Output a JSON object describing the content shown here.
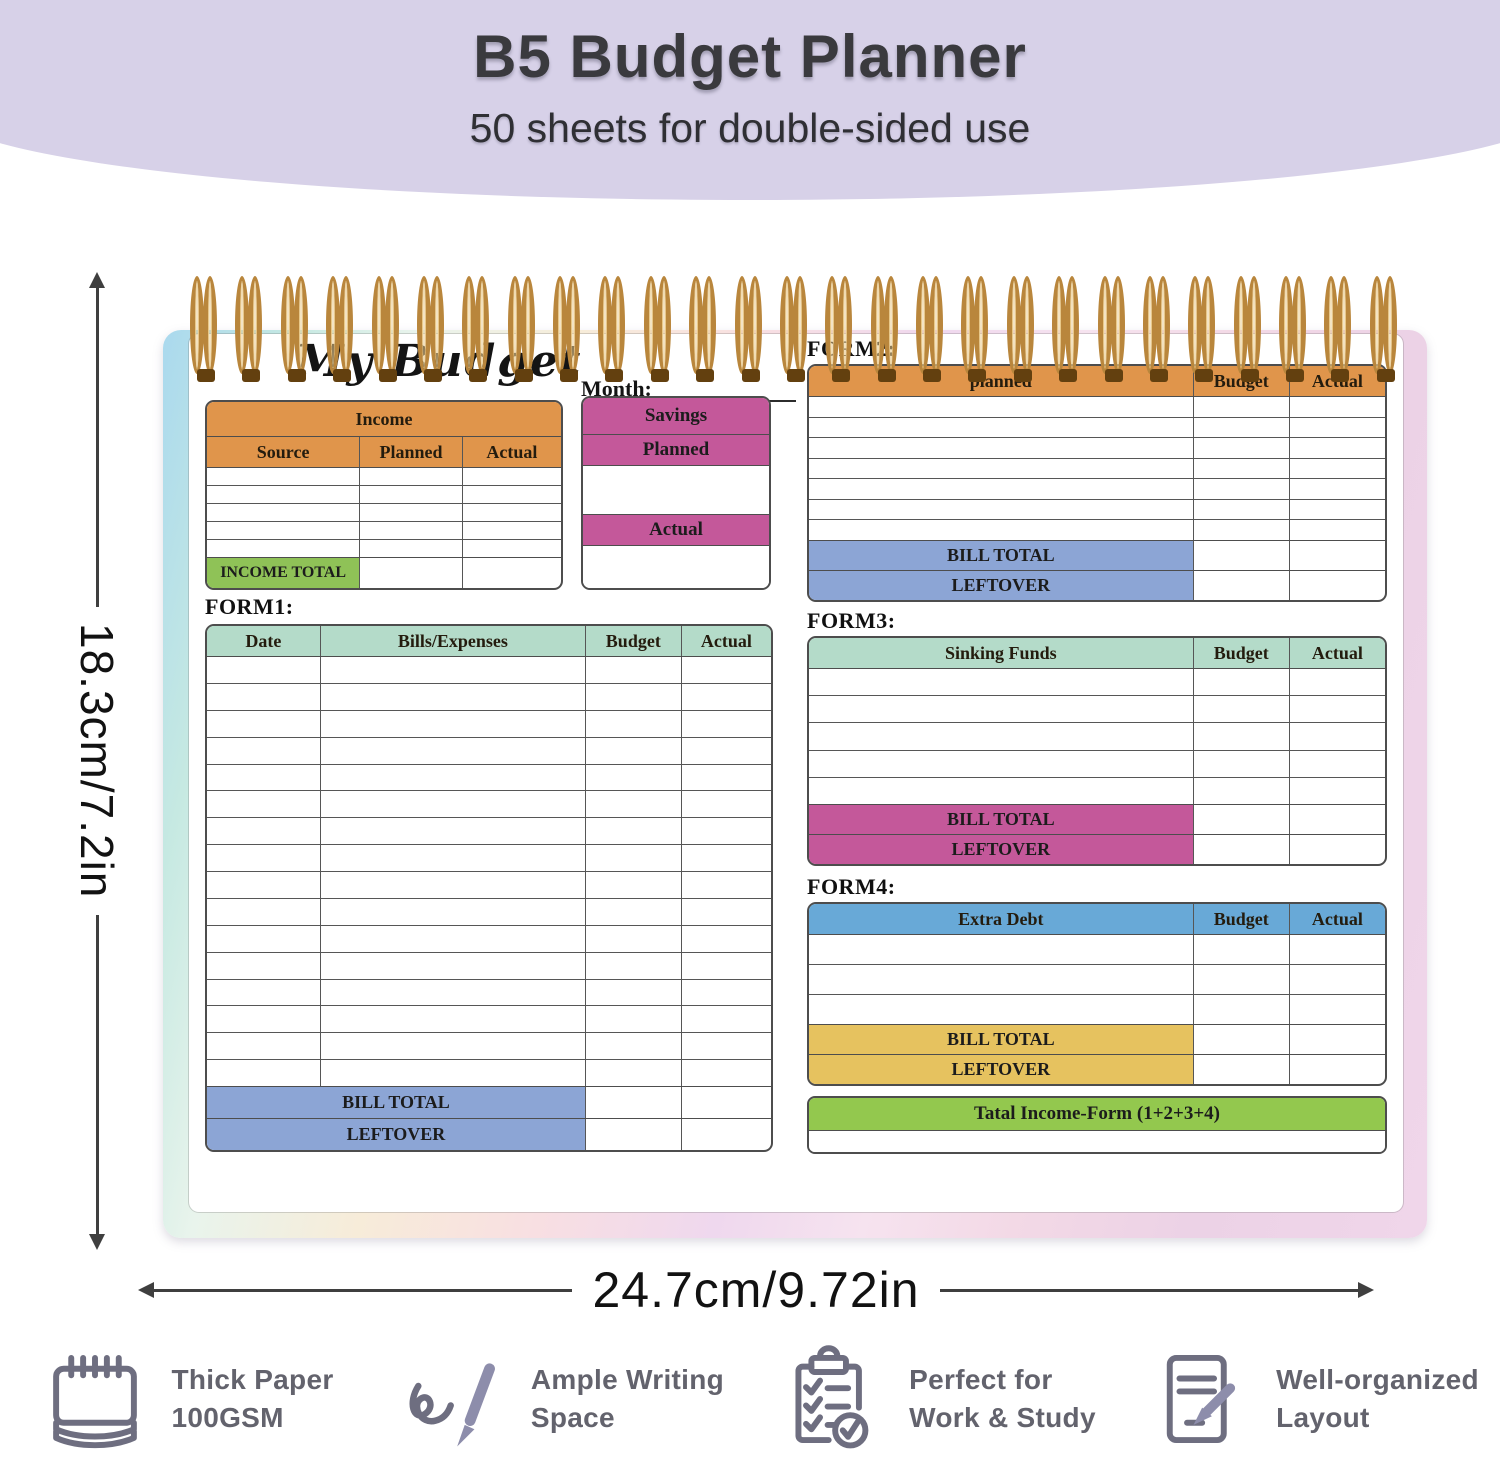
{
  "header": {
    "title": "B5 Budget Planner",
    "subtitle": "50 sheets for double-sided use"
  },
  "dimensions": {
    "height": "18.3cm/7.2in",
    "width": "24.7cm/9.72in"
  },
  "planner": {
    "spiral_count": 27,
    "page_title": "My Budget",
    "month_label": "Month:",
    "income": {
      "header": "Income",
      "columns": [
        "Source",
        "Planned",
        "Actual"
      ],
      "row_count": 5,
      "total_label": "INCOME TOTAL"
    },
    "savings": {
      "header": "Savings",
      "planned_label": "Planned",
      "actual_label": "Actual"
    },
    "form1": {
      "label": "FORM1:",
      "columns": [
        "Date",
        "Bills/Expenses",
        "Budget",
        "Actual"
      ],
      "row_count": 16,
      "bill_total_label": "BILL TOTAL",
      "leftover_label": "LEFTOVER"
    },
    "form2": {
      "label": "FORM2:",
      "columns": [
        "planned",
        "Budget",
        "Actual"
      ],
      "row_count": 7,
      "bill_total_label": "BILL TOTAL",
      "leftover_label": "LEFTOVER"
    },
    "form3": {
      "label": "FORM3:",
      "columns": [
        "Sinking Funds",
        "Budget",
        "Actual"
      ],
      "row_count": 5,
      "bill_total_label": "BILL TOTAL",
      "leftover_label": "LEFTOVER"
    },
    "form4": {
      "label": "FORM4:",
      "columns": [
        "Extra Debt",
        "Budget",
        "Actual"
      ],
      "row_count": 3,
      "bill_total_label": "BILL TOTAL",
      "leftover_label": "LEFTOVER"
    },
    "grand_total_label": "Tatal Income-Form (1+2+3+4)"
  },
  "features": [
    {
      "icon": "notepad-icon",
      "line1": "Thick Paper",
      "line2": "100GSM"
    },
    {
      "icon": "pen-writing-icon",
      "line1": "Ample Writing",
      "line2": "Space"
    },
    {
      "icon": "clipboard-check-icon",
      "line1": "Perfect for",
      "line2": "Work & Study"
    },
    {
      "icon": "document-layout-icon",
      "line1": "Well-organized",
      "line2": "Layout"
    }
  ],
  "colors": {
    "hero_bg": "#d7d1e8",
    "orange": "#e0954b",
    "teal": "#b4dbc9",
    "magenta": "#c4589a",
    "periwinkle": "#8ca5d5",
    "blue": "#68a9d7",
    "yellow": "#e6c25f",
    "green_total": "#8fc257",
    "lime": "#93c84e",
    "spiral_gold": "#b9863c",
    "spiral_tip": "#63400f",
    "dim_line": "#3f3f3f",
    "feature_text": "#63636d",
    "feature_icon": "#6e6e80",
    "pen_accent": "#8d8dab"
  }
}
